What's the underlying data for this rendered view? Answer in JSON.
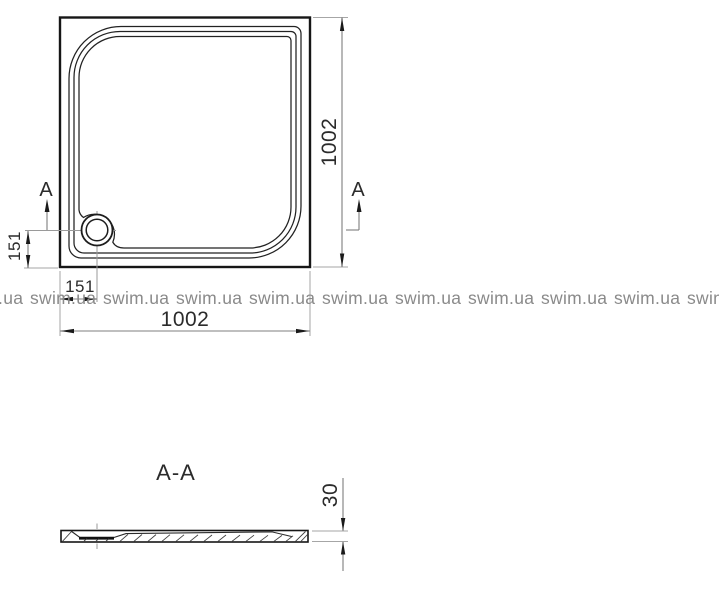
{
  "watermark": {
    "text": "swim.ua",
    "color": "#8a8a8a"
  },
  "top_view": {
    "width_label": "1002",
    "height_label": "1002",
    "drain_offset_x_label": "151",
    "drain_offset_y_label": "151",
    "section_marker_left": "A",
    "section_marker_right": "A"
  },
  "section_view": {
    "title": "A-A",
    "thickness_label": "30"
  },
  "colors": {
    "background": "#ffffff",
    "outline": "#161616",
    "dimension_line": "#7f7f7f",
    "extension_line": "#a6a6a6",
    "text": "#2b2b2b",
    "watermark": "#8a8a8a"
  }
}
